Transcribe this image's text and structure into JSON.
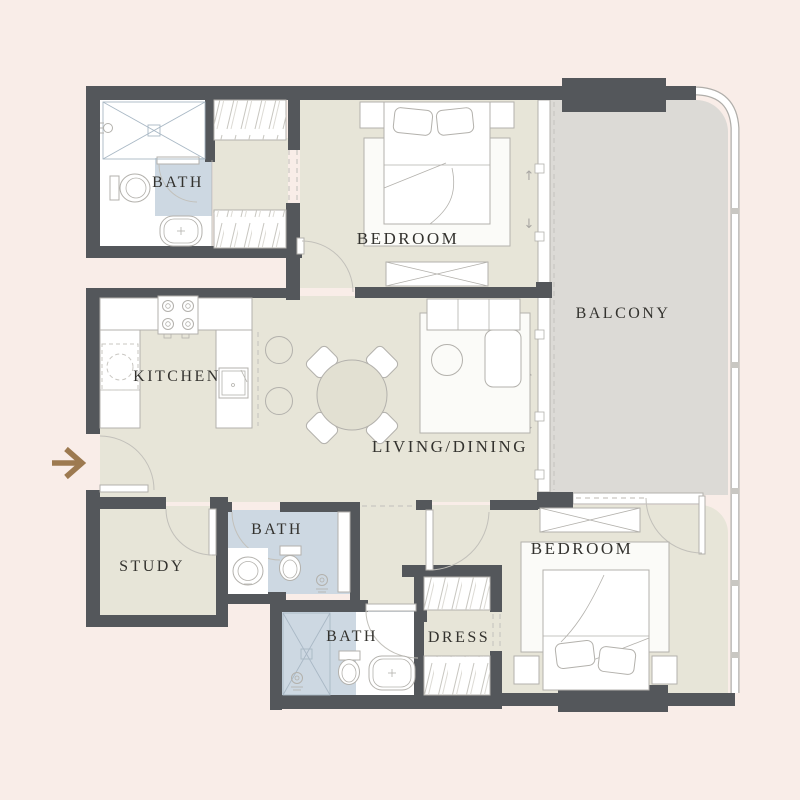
{
  "palette": {
    "background": "#f9ede8",
    "wall": "#54575b",
    "floor": "#e7e5d8",
    "bath-floor": "#cdd8e2",
    "balcony-floor": "#dcdad6",
    "outline": "#b3b1ac",
    "dash": "#c9c7c2",
    "label": "#33322e",
    "arrow": "#9d7a50"
  },
  "rooms": {
    "bath_top": {
      "label": "BATH"
    },
    "bedroom_top": {
      "label": "BEDROOM"
    },
    "balcony": {
      "label": "BALCONY"
    },
    "kitchen": {
      "label": "KITCHEN"
    },
    "living_dining": {
      "label": "LIVING/DINING"
    },
    "study": {
      "label": "STUDY"
    },
    "bath_middle": {
      "label": "BATH"
    },
    "bath_bottom": {
      "label": "BATH"
    },
    "dress": {
      "label": "DRESS"
    },
    "bedroom_bottom": {
      "label": "BEDROOM"
    }
  },
  "glyphs": {
    "slide_up": "↑",
    "slide_down": "↓"
  }
}
